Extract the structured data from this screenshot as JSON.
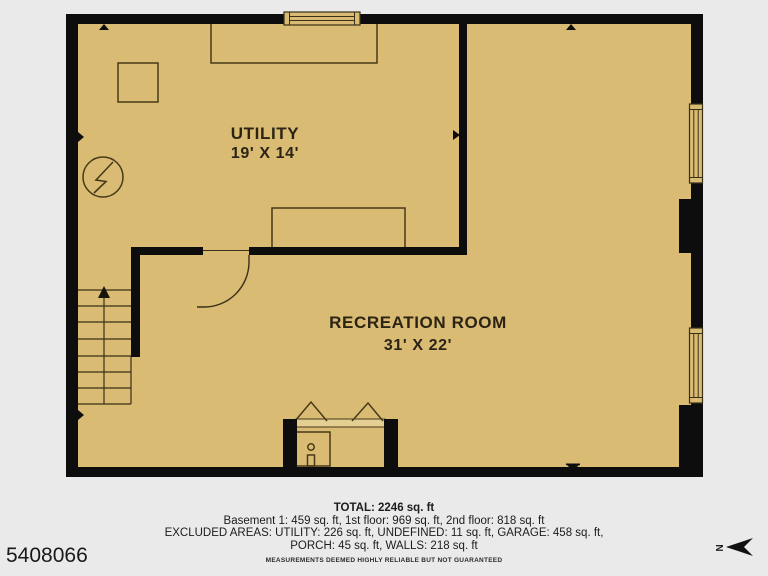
{
  "colors": {
    "background": "#eaeaea",
    "floor": "#d9bb73",
    "walls": "#0d0d0d",
    "furniture_line": "#473a17",
    "label_text": "#2b2414",
    "alcove_band": "#e4cf93"
  },
  "plan": {
    "rooms": [
      {
        "name": "UTILITY",
        "dims": "19' X 14'"
      },
      {
        "name": "RECREATION ROOM",
        "dims": "31' X 22'"
      }
    ]
  },
  "footer": {
    "total": "TOTAL: 2246 sq. ft",
    "floors": "Basement 1: 459 sq. ft, 1st floor: 969 sq. ft, 2nd floor: 818 sq. ft",
    "excluded": "EXCLUDED AREAS: UTILITY: 226 sq. ft, UNDEFINED: 11 sq. ft, GARAGE: 458 sq. ft,",
    "excluded2": "PORCH: 45 sq. ft, WALLS: 218 sq. ft",
    "disclaimer": "MEASUREMENTS DEEMED HIGHLY RELIABLE BUT NOT GUARANTEED"
  },
  "listing_id": "5408066",
  "compass": {
    "north_label": "N"
  }
}
